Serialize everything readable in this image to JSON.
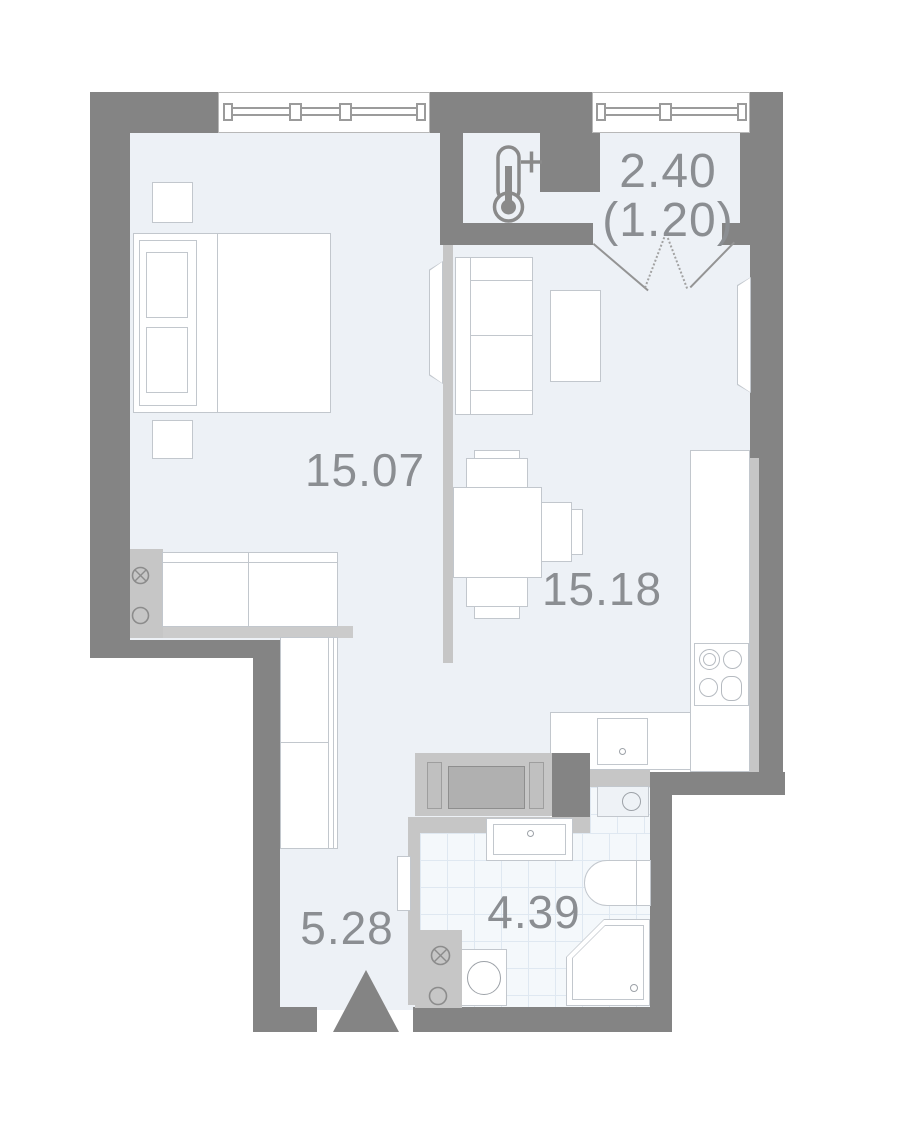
{
  "rooms": [
    {
      "key": "bedroom",
      "area_label": "15.07"
    },
    {
      "key": "living-kitchen",
      "area_label": "15.18"
    },
    {
      "key": "hallway",
      "area_label": "5.28"
    },
    {
      "key": "bathroom",
      "area_label": "4.39"
    },
    {
      "key": "balcony",
      "area_label": "2.40",
      "area_secondary_label": "(1.20)"
    }
  ],
  "icons": {
    "warm_balcony": "thermometer-plus-icon",
    "entrance": "entrance-arrow-icon",
    "vent": "crossed-circle-vent-icon",
    "socket": "circle-outlet-icon"
  },
  "colors": {
    "wall": "#848484",
    "partition": "#c6c6c6",
    "floor": "#edf1f6",
    "tile_bg": "#f4f8fb",
    "tile_line": "#dfe8f1",
    "furniture_outline": "#c2c7cd",
    "label_text": "#8b8e92"
  }
}
